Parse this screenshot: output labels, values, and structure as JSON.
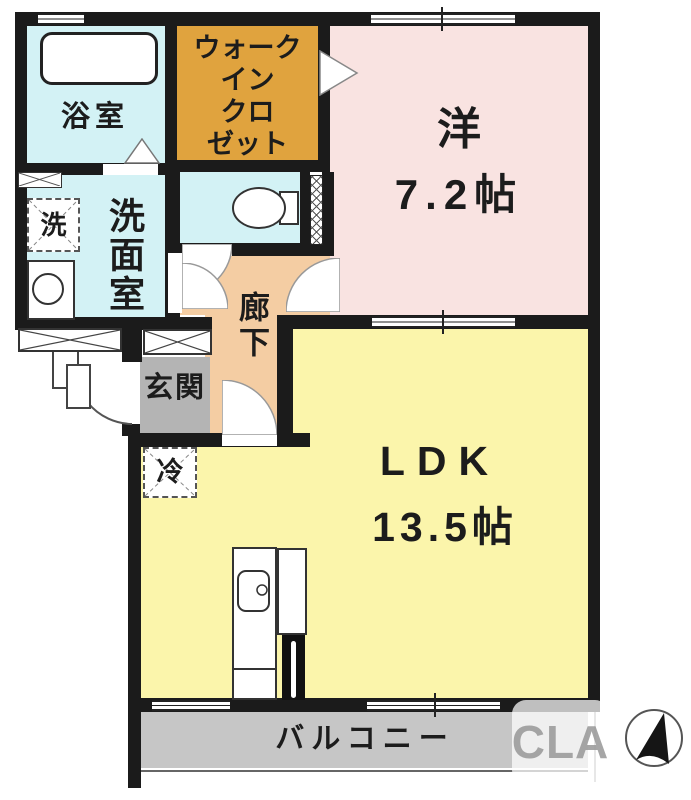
{
  "floorplan": {
    "rooms": {
      "bathroom": {
        "label": "浴室"
      },
      "walk_in_closet": {
        "label": "ウォークインクロゼット",
        "lines": [
          "ウォーク",
          "イン",
          "クロ",
          "ゼット"
        ]
      },
      "western_room": {
        "label": "洋",
        "size": "7.2帖"
      },
      "washroom": {
        "label": "洗面室"
      },
      "washer": {
        "label": "洗"
      },
      "corridor": {
        "label": "廊下"
      },
      "entrance": {
        "label": "玄関"
      },
      "refrigerator": {
        "label": "冷"
      },
      "ldk": {
        "label": "LDK",
        "size": "13.5帖"
      },
      "balcony": {
        "label": "バルコニー"
      }
    },
    "watermark": {
      "text": "CLA"
    },
    "colors": {
      "wall": "#1b1b1b",
      "water": "#d3f2f5",
      "wic": "#e0a33e",
      "pink": "#f9e3e1",
      "yellow": "#fbf5ab",
      "peach": "#f4cda3",
      "genkan": "#b4b4b4",
      "balcony": "#c6c6c6"
    }
  }
}
